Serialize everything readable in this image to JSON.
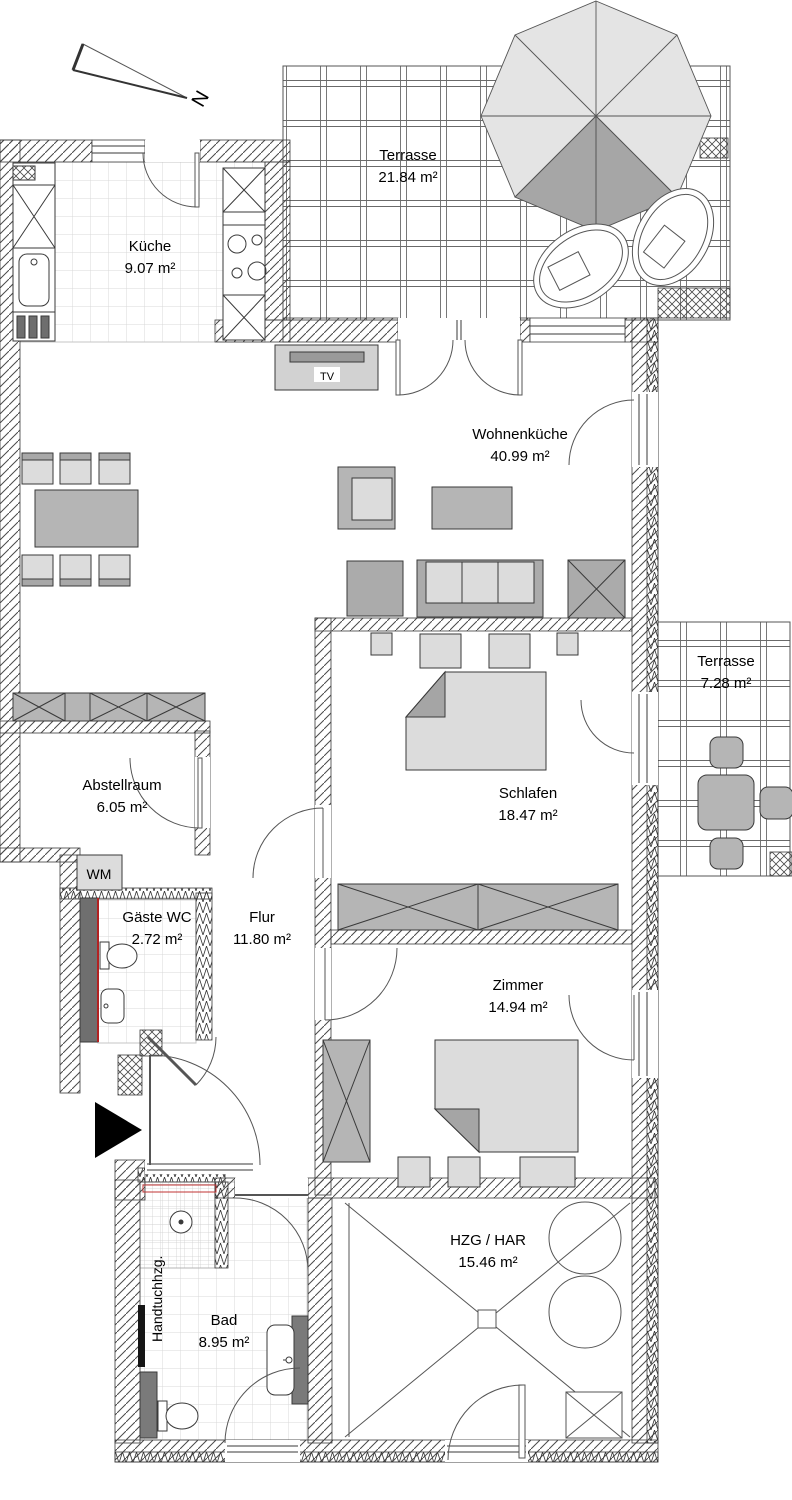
{
  "plan": {
    "compass_label": "N",
    "rooms": {
      "terrasse_top": {
        "name": "Terrasse",
        "area": "21.84 m²"
      },
      "kueche": {
        "name": "Küche",
        "area": "9.07 m²"
      },
      "wohnenkueche": {
        "name": "Wohnenküche",
        "area": "40.99 m²"
      },
      "terrasse_right": {
        "name": "Terrasse",
        "area": "7.28 m²"
      },
      "abstellraum": {
        "name": "Abstellraum",
        "area": "6.05 m²"
      },
      "schlafen": {
        "name": "Schlafen",
        "area": "18.47 m²"
      },
      "gaeste_wc": {
        "name": "Gäste WC",
        "area": "2.72 m²"
      },
      "flur": {
        "name": "Flur",
        "area": "11.80 m²"
      },
      "zimmer": {
        "name": "Zimmer",
        "area": "14.94 m²"
      },
      "bad": {
        "name": "Bad",
        "area": "8.95 m²"
      },
      "hzg_har": {
        "name": "HZG / HAR",
        "area": "15.46 m²"
      }
    },
    "fixtures": {
      "tv": "TV",
      "wm": "WM",
      "handtuchheizung": "Handtuchhzg."
    },
    "colors": {
      "wall_line": "#3a3a3a",
      "furniture_mid": "#b5b5b5",
      "furniture_light": "#dcdcdc",
      "furniture_dark": "#9e9e9e",
      "accent_red": "#b22222",
      "parasol_light": "#e4e4e4",
      "parasol_dark": "#a6a6a6"
    }
  }
}
